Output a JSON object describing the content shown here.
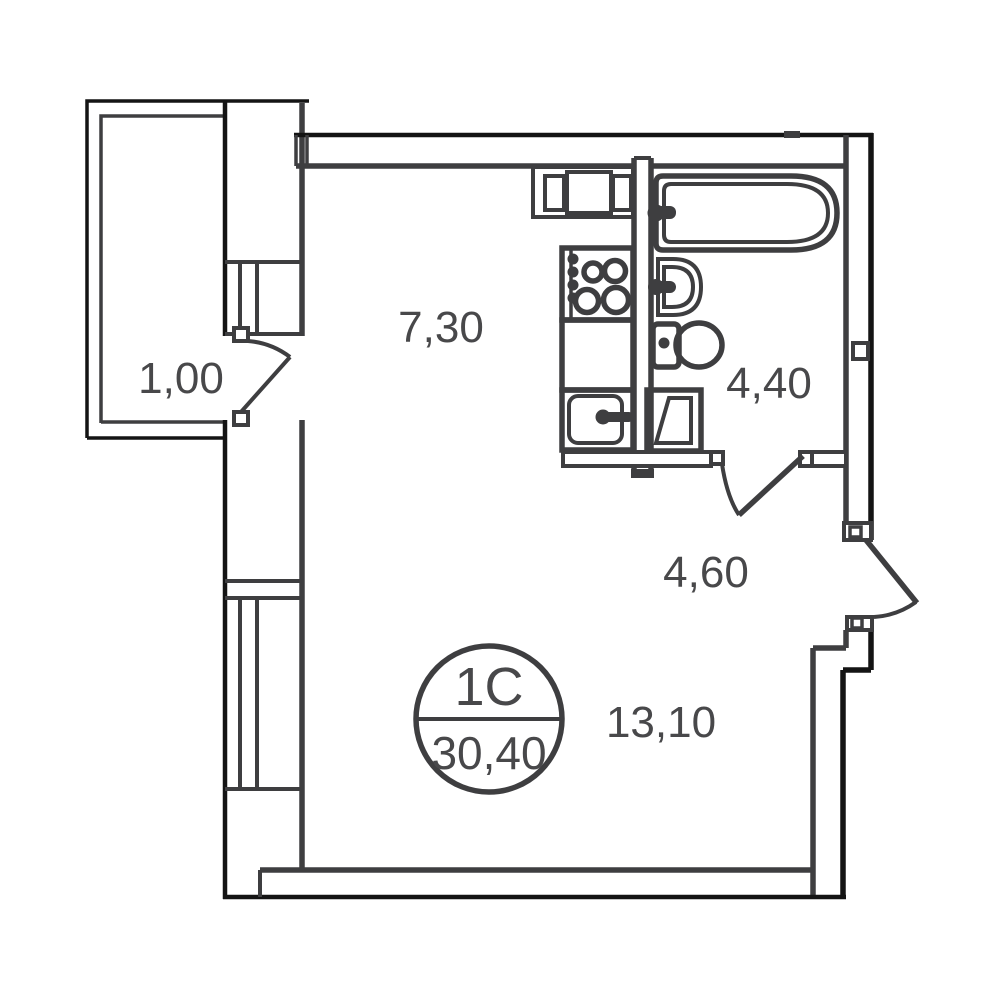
{
  "plan": {
    "unit_badge": {
      "type": "1C",
      "total_area": "30,40"
    },
    "rooms": [
      {
        "name": "balcony",
        "area": "1,00"
      },
      {
        "name": "kitchen",
        "area": "7,30"
      },
      {
        "name": "bathroom",
        "area": "4,40"
      },
      {
        "name": "hallway",
        "area": "4,60"
      },
      {
        "name": "living-room",
        "area": "13,10"
      }
    ],
    "fixtures": [
      "bathtub",
      "wash-basin",
      "toilet",
      "shower-tray",
      "stove",
      "kitchen-counter",
      "kitchen-sink",
      "kitchen-cabinet"
    ],
    "colors": {
      "wall": "#3e3e40",
      "outline": "#141414",
      "text": "#48484a",
      "bg": "#ffffff"
    }
  }
}
